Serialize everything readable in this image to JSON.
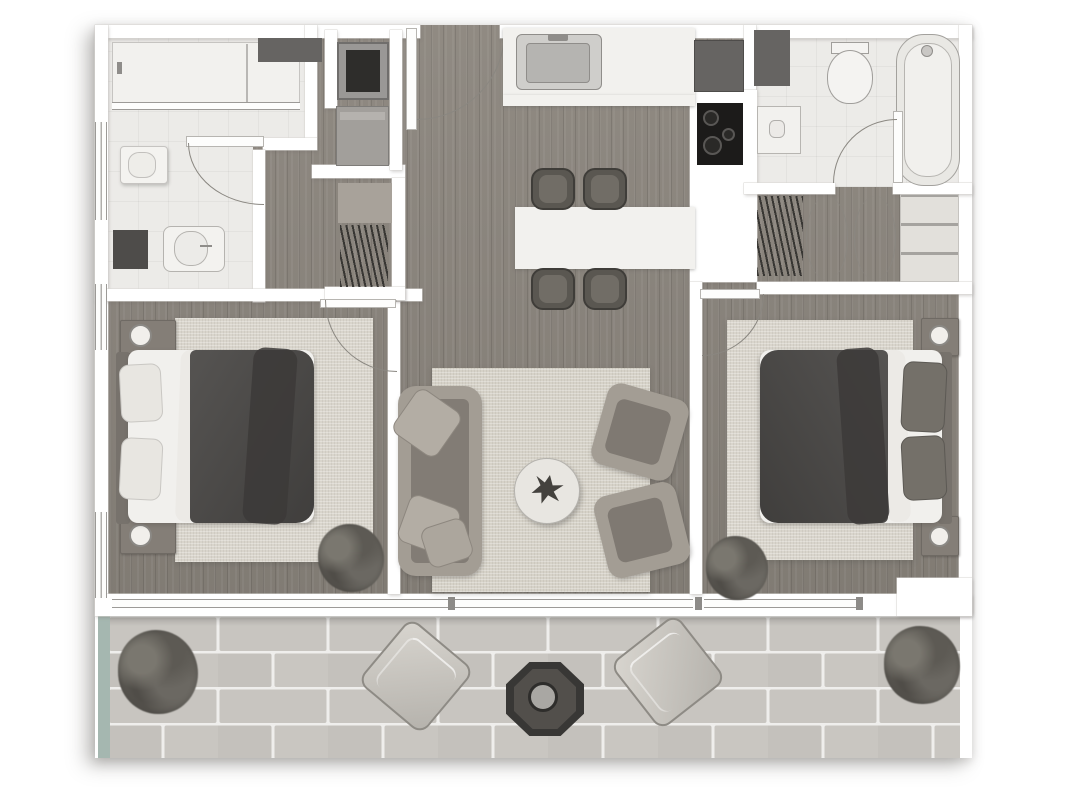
{
  "meta": {
    "type": "architectural-floor-plan",
    "view": "top-down",
    "style": "grayscale rendered plan of a two-bedroom apartment with terrace",
    "visible_text": []
  },
  "palette": {
    "page_bg": "#ffffff",
    "wall": "#ffffff",
    "wall_edge": "#d8d6d3",
    "floor_wood": "#8a847c",
    "floor_tile": "#ecebe8",
    "rug": "#d9d5cc",
    "counter": "#f2f1ee",
    "duvet": "#4b4947",
    "throw": "#3c3a38",
    "upholstery": "#a39d94",
    "upholstery_dark": "#827c75",
    "appliance": "#666462",
    "cooktop": "#1c1b1a",
    "steel": "#cfcecb",
    "chair": "#5a5751",
    "paver": "#c7c4bf",
    "paver_joint": "#efeeec",
    "planter": "#a5b7b0",
    "plant": "#575550",
    "arc_line": "#8a8781",
    "frame": "#9c9a97"
  },
  "rooms": [
    {
      "id": "bathroom-left",
      "name": "Bathroom (top left)"
    },
    {
      "id": "laundry-hall",
      "name": "Laundry hallway"
    },
    {
      "id": "closet-left",
      "name": "Closet with hangers (left hall)"
    },
    {
      "id": "entry",
      "name": "Entry"
    },
    {
      "id": "kitchen",
      "name": "Kitchen"
    },
    {
      "id": "bathroom-right",
      "name": "Bathroom (top right)"
    },
    {
      "id": "closet-right",
      "name": "Walk-in closet (right corridor)"
    },
    {
      "id": "bedroom-left",
      "name": "Bedroom (left)"
    },
    {
      "id": "living-room",
      "name": "Living room"
    },
    {
      "id": "bedroom-right",
      "name": "Bedroom (right)"
    },
    {
      "id": "terrace",
      "name": "Terrace with brick pavers"
    }
  ],
  "furniture": {
    "bathroom_left": [
      "shower",
      "glass-screen",
      "vanity-sink",
      "toilet",
      "laundry-bin"
    ],
    "laundry_hall": [
      "stacked-washer",
      "dryer-cabinet",
      "dark-lintel-cabinet",
      "hanger-rod"
    ],
    "kitchen": [
      "sink",
      "counter",
      "refrigerator",
      "cooktop",
      "island-counter",
      "bar-chair x4"
    ],
    "bathroom_right": [
      "toilet",
      "wash-basin",
      "bathtub",
      "utility-shaft"
    ],
    "closet_right": [
      "hanger-rod",
      "bifold-doors",
      "linen-shelves"
    ],
    "bedroom_left": [
      "double-bed",
      "dark-duvet",
      "pillows x2",
      "headboard",
      "nightstand x2",
      "lamp x2",
      "area-rug",
      "plant"
    ],
    "living_room": [
      "sofa",
      "throw-pillows x3",
      "armchair x2",
      "round-coffee-table",
      "table-plant",
      "area-rug"
    ],
    "bedroom_right": [
      "double-bed",
      "dark-duvet",
      "pillows x2",
      "headboard",
      "nightstand x2",
      "lamp x2",
      "area-rug",
      "plant"
    ],
    "terrace": [
      "shrub-planter x2",
      "lounge-cushion x2",
      "fire-pit-table",
      "planter-edge"
    ]
  },
  "features": {
    "windows": [
      "left-wall-window-1",
      "left-wall-window-2",
      "left-wall-window-3",
      "bottom-sliding-glass-wall"
    ],
    "doors": [
      "entry-door-with-swing",
      "bathroom-left-door",
      "bathroom-right-door",
      "bedroom-left-door",
      "bedroom-right-door",
      "closet-bifold-doors"
    ]
  }
}
